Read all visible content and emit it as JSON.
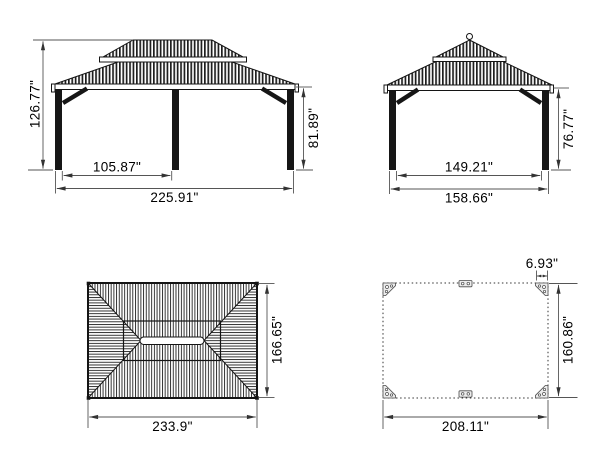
{
  "drawing": {
    "subject": "gazebo-dimension-drawing",
    "unit": "inches",
    "ink_color": "#141414",
    "dim_color": "#555555"
  },
  "views": {
    "front_elevation": {
      "overall_height": "126.77\"",
      "post_spacing": "105.87\"",
      "overall_width": "225.91\"",
      "eave_height": "81.89\""
    },
    "side_elevation": {
      "eave_height": "76.77\"",
      "post_spacing": "149.21\"",
      "overall_width": "158.66\""
    },
    "roof_plan": {
      "roof_width": "233.9\"",
      "roof_depth": "166.65\""
    },
    "base_plan": {
      "corner_plate_width": "6.93\"",
      "base_width": "208.11\"",
      "base_depth": "160.86\""
    }
  }
}
